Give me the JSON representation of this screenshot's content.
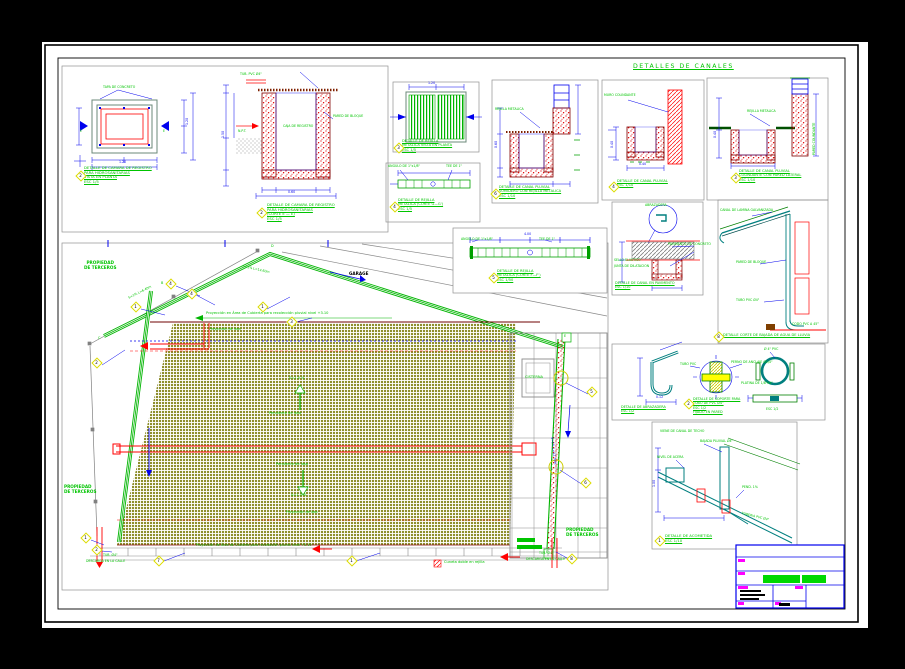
{
  "colors": {
    "green": "#00C400",
    "blue": "#0000EE",
    "red": "#FF0000",
    "teal": "#007F7F",
    "olive": "#8F8F2E",
    "yellow": "#FFFF00",
    "magenta": "#FF00FF",
    "gray": "#808080",
    "maroon": "#7F0000",
    "black": "#000000",
    "white": "#FFFFFF"
  },
  "titles": {
    "sheet": "DETALLES  DE  CANALES"
  },
  "callouts": {
    "n1": "1",
    "n2": "2",
    "n3": "3",
    "n4": "4",
    "n5": "5",
    "n6": "6",
    "n7": "7",
    "n8": "8"
  },
  "dims": {
    "d400": "4.00",
    "d150": "1.50",
    "d120": "1.20",
    "d100": "1.00",
    "d60": "0.60",
    "d40": "0.40",
    "d12": "0.12"
  },
  "details": {
    "camara_planta": {
      "lines": [
        "DETALLE DE CAMARA DE REGISTRO",
        "PARA HIDROSANITARIAS",
        "VISTA EN PLANTA",
        "ESC 1/5"
      ],
      "tapa": "TAPA DE CONCRETO"
    },
    "camara_corte": {
      "lines": [
        "DETALLE DE CAMARA DE REGISTRO",
        "PARA HIDROSANITARIAS",
        "(CORTE E — E)",
        "ESC 1/5"
      ],
      "pared": "PARED DE BLOQUE",
      "caja": "CAJA DE REGISTRO",
      "tubo": "TUB. PVC Ø4\"",
      "npt": "N.P.T."
    },
    "rejilla_planta": {
      "lines": [
        "DETALLE DE REJILLA",
        "METALICA VISTA EN PLANTA",
        "ESC 1/5"
      ]
    },
    "rejilla_g": {
      "lines": [
        "DETALLE DE REJILLA",
        "METALICA (CORTE G—G')",
        "ESC 1/5"
      ],
      "angulo": "ANGULO DE 1\"x1/8\"",
      "tee": "TEE DE 1\""
    },
    "rejilla_f": {
      "lines": [
        "DETALLE DE REJILLA",
        "METALICA (CORTE F—F')",
        "ESC 1/50"
      ],
      "angulo": "ANGULO DE 1\"x1/8\"",
      "tee": "TEE DE 1\""
    },
    "sumidero": {
      "lines": [
        "DETALLE DE CANAL PLUVIAL",
        "SUMIDERO CON REJILLA METALICA",
        "ESC 1/10"
      ],
      "rejilla": "REJILLA METALICA"
    },
    "canal_a": {
      "lines": [
        "DETALLE DE CANAL PLUVIAL",
        "ESC 1/10"
      ],
      "muro": "MURO COLINDANTE"
    },
    "canal_b": {
      "lines": [
        "DETALLE DE CANAL PLUVIAL",
        "COLINDANTE CON PARED LATERAL",
        "ESC 1/10"
      ],
      "rejilla": "REJILLA METALICA",
      "pared": "PARED COLINDANTE"
    },
    "pavimento": {
      "lines": [
        "DETALLE DE CANAL EN PAVIMENTO",
        "ESC 1/10"
      ],
      "abraz": "ABRAZADERA",
      "pav": "PAVIMENTO DE CONCRETO",
      "sello": "SELLO ELASTICO",
      "junta": "JUNTA DE DILATACION"
    },
    "bajada": {
      "title": "DETALLE CORTE DE BAJADA DE AGUA DE LLUVIA",
      "canal": "CANAL DE LAMINA GALVANIZADA",
      "pared": "PARED DE BLOQUE",
      "tubo": "TUBO PVC Ø4\"",
      "codo": "CODO PVC A 45°"
    },
    "gancho": {
      "lines": [
        "DETALLE DE ABRAZADERA",
        "ESC 1/2"
      ]
    },
    "soporte": {
      "lines": [
        "DETALLE DE SOPORTE PARA",
        "TUBO DE PVC Ø4\"",
        "ESC 1/2",
        "FIJADO EN PARED"
      ],
      "tubo": "TUBO PVC",
      "perno": "PERNO DE ANCLAJE Ø1/4\""
    },
    "abrazadera": {
      "dia": "Ø 4\" PVC",
      "platina": "PLATINA DE 1/8\"x1\"",
      "esc": "ESC 1/2"
    },
    "acometida": {
      "lines": [
        "DETALLE DE ACOMETIDA",
        "ESC 1/10"
      ],
      "bajada": "BAJADA PLUVIAL Ø4\"",
      "tuberia": "TUBERIA PVC Ø4\"",
      "pend": "PEND. 1%",
      "nivel": "NIVEL DE ACERA",
      "viene": "VIENE DE CANAL DE TECHO"
    }
  },
  "plan": {
    "propiedad1": "PROPIEDAD",
    "propiedad2": "DE TERCEROS",
    "garage": "GARAGE",
    "cisterna": "CISTERNA",
    "proy_top": "Proyección en Área de Cubierta para recolección pluvial  nivel +3.10",
    "proy_losa": "Proyección de losa",
    "proy_bottom": "Proyección de Área de Cubierta para recolección pluvial nivel +3.10",
    "slope": "S=1.0 %",
    "pendiente": "Pendiente de losa",
    "s_left": "S=1%  L=6.40m",
    "s_top": "S=1%  L=14.60m",
    "s_right": "S=1%  L=12.70m",
    "tub": "TUB. Ø4\"",
    "descarga": "DESCARGA EN LA CALLE",
    "legend": "Cuneta doble en rejilla",
    "mB": "B",
    "mC": "C",
    "mD": "D",
    "mE": "E"
  }
}
